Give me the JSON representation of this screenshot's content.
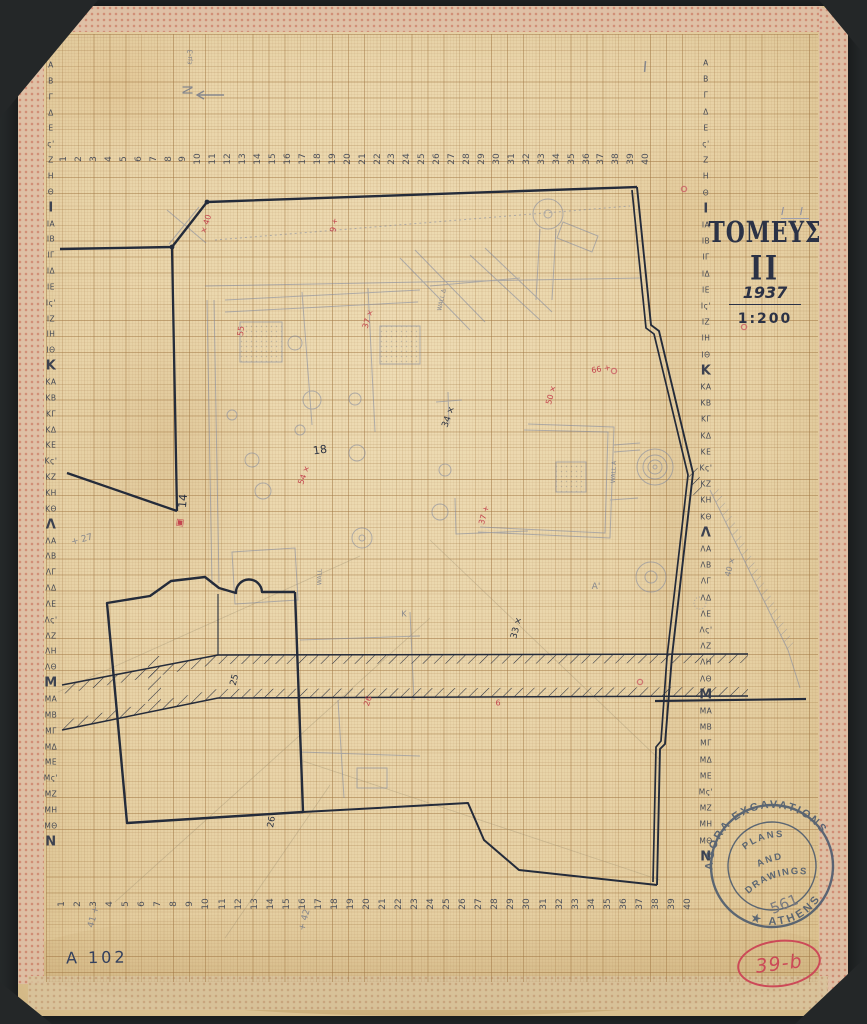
{
  "title_block": {
    "pencil_note": "Ι Ι",
    "title": "ΤΟΜΕΥΣ",
    "title_numeral": "ΙΙ",
    "year": "1937",
    "scale": "1:200"
  },
  "catalog": {
    "drawing_number": "A 102",
    "circled_number": "39-b"
  },
  "stamp": {
    "ring_top": "AGORA EXCAVATIONS",
    "ring_bottom": "★ ATHENS",
    "line1": "PLANS",
    "line2": "AND",
    "line3": "DRAWINGS",
    "number": "561"
  },
  "north": {
    "label": "N"
  },
  "colors": {
    "ink": "#242b3a",
    "red": "#c4464f",
    "pencil": "#7c86a0",
    "stamp": "#45566d",
    "paper": "#e8d3a7"
  },
  "grid": {
    "layout": {
      "top": {
        "x0": 64,
        "dx": 14.93,
        "y": 159
      },
      "bottom": {
        "x0": 62,
        "dx": 16.05,
        "y": 904
      },
      "left": {
        "x": 51,
        "y0": 65,
        "dy": 15.85
      },
      "right": {
        "x": 706,
        "y0": 63,
        "dy": 16.2
      }
    },
    "milestones": [
      "Ι",
      "Κ",
      "Λ",
      "Μ",
      "Ν"
    ],
    "top_numbers": [
      "1",
      "2",
      "3",
      "4",
      "5",
      "6",
      "7",
      "8",
      "9",
      "10",
      "11",
      "12",
      "13",
      "14",
      "15",
      "16",
      "17",
      "18",
      "19",
      "20",
      "21",
      "22",
      "23",
      "24",
      "25",
      "26",
      "27",
      "28",
      "29",
      "30",
      "31",
      "32",
      "33",
      "34",
      "35",
      "36",
      "37",
      "38",
      "39",
      "40"
    ],
    "bottom_numbers": [
      "1",
      "2",
      "3",
      "4",
      "5",
      "6",
      "7",
      "8",
      "9",
      "10",
      "11",
      "12",
      "13",
      "14",
      "15",
      "16",
      "17",
      "18",
      "19",
      "20",
      "21",
      "22",
      "23",
      "24",
      "25",
      "26",
      "27",
      "28",
      "29",
      "30",
      "31",
      "32",
      "33",
      "34",
      "35",
      "36",
      "37",
      "38",
      "39",
      "40"
    ],
    "left_letters": [
      "Α",
      "Β",
      "Γ",
      "Δ",
      "Ε",
      "ς'",
      "Ζ",
      "Η",
      "Θ",
      "Ι",
      "ΙΑ",
      "ΙΒ",
      "ΙΓ",
      "ΙΔ",
      "ΙΕ",
      "Ις'",
      "ΙΖ",
      "ΙΗ",
      "ΙΘ",
      "Κ",
      "ΚΑ",
      "ΚΒ",
      "ΚΓ",
      "ΚΔ",
      "ΚΕ",
      "Κς'",
      "ΚΖ",
      "ΚΗ",
      "ΚΘ",
      "Λ",
      "ΛΑ",
      "ΛΒ",
      "ΛΓ",
      "ΛΔ",
      "ΛΕ",
      "Λς'",
      "ΛΖ",
      "ΛΗ",
      "ΛΘ",
      "Μ",
      "ΜΑ",
      "ΜΒ",
      "ΜΓ",
      "ΜΔ",
      "ΜΕ",
      "Μς'",
      "ΜΖ",
      "ΜΗ",
      "ΜΘ",
      "Ν"
    ],
    "right_letters": [
      "Α",
      "Β",
      "Γ",
      "Δ",
      "Ε",
      "ς'",
      "Ζ",
      "Η",
      "Θ",
      "Ι",
      "ΙΑ",
      "ΙΒ",
      "ΙΓ",
      "ΙΔ",
      "ΙΕ",
      "Ις'",
      "ΙΖ",
      "ΙΗ",
      "ΙΘ",
      "Κ",
      "ΚΑ",
      "ΚΒ",
      "ΚΓ",
      "ΚΔ",
      "ΚΕ",
      "Κς'",
      "ΚΖ",
      "ΚΗ",
      "ΚΘ",
      "Λ",
      "ΛΑ",
      "ΛΒ",
      "ΛΓ",
      "ΛΔ",
      "ΛΕ",
      "Λς'",
      "ΛΖ",
      "ΛΗ",
      "ΛΘ",
      "Μ",
      "ΜΑ",
      "ΜΒ",
      "ΜΓ",
      "ΜΔ",
      "ΜΕ",
      "Μς'",
      "ΜΖ",
      "ΜΗ",
      "ΜΘ",
      "Ν"
    ]
  },
  "annotations": [
    {
      "t": "× 40",
      "x": 206,
      "y": 224,
      "r": -72,
      "c": "red",
      "s": 8
    },
    {
      "t": "9 +",
      "x": 334,
      "y": 225,
      "r": -80,
      "c": "red",
      "s": 8
    },
    {
      "t": "55",
      "x": 241,
      "y": 331,
      "r": -85,
      "c": "red",
      "s": 8
    },
    {
      "t": "37 ×",
      "x": 368,
      "y": 319,
      "r": -72,
      "c": "red",
      "s": 8
    },
    {
      "t": "50 ×",
      "x": 551,
      "y": 395,
      "r": -75,
      "c": "red",
      "s": 8
    },
    {
      "t": "66 +",
      "x": 601,
      "y": 369,
      "r": -10,
      "c": "red",
      "s": 8
    },
    {
      "t": "54 ×",
      "x": 304,
      "y": 475,
      "r": -70,
      "c": "red",
      "s": 8
    },
    {
      "t": "37 +",
      "x": 484,
      "y": 515,
      "r": -75,
      "c": "red",
      "s": 8
    },
    {
      "t": "26",
      "x": 368,
      "y": 701,
      "r": -72,
      "c": "red",
      "s": 8
    },
    {
      "t": "6",
      "x": 498,
      "y": 703,
      "r": 0,
      "c": "red",
      "s": 8
    },
    {
      "t": "▣",
      "x": 180,
      "y": 523,
      "r": 8,
      "c": "red",
      "s": 9
    },
    {
      "t": "14",
      "x": 183,
      "y": 501,
      "r": -85,
      "c": "ink",
      "s": 11
    },
    {
      "t": "18",
      "x": 320,
      "y": 450,
      "r": -8,
      "c": "ink",
      "s": 11
    },
    {
      "t": "34 ×",
      "x": 449,
      "y": 417,
      "r": -70,
      "c": "ink",
      "s": 9
    },
    {
      "t": "33 ×",
      "x": 517,
      "y": 628,
      "r": -75,
      "c": "ink",
      "s": 9
    },
    {
      "t": "25",
      "x": 235,
      "y": 680,
      "r": -75,
      "c": "ink",
      "s": 9
    },
    {
      "t": "26",
      "x": 272,
      "y": 822,
      "r": -80,
      "c": "ink",
      "s": 9
    },
    {
      "t": "+ 27",
      "x": 82,
      "y": 540,
      "r": -15,
      "c": "pencil",
      "s": 9
    },
    {
      "t": "41 +",
      "x": 94,
      "y": 917,
      "r": -75,
      "c": "pencil",
      "s": 9
    },
    {
      "t": "+ 42",
      "x": 305,
      "y": 920,
      "r": -75,
      "c": "pencil",
      "s": 9
    },
    {
      "t": "N",
      "x": 186,
      "y": 90,
      "r": 90,
      "c": "pencil",
      "s": 13
    },
    {
      "t": "εμ-3",
      "x": 190,
      "y": 57,
      "r": -85,
      "c": "pencil",
      "s": 7
    },
    {
      "t": "Ι",
      "x": 645,
      "y": 67,
      "r": 5,
      "c": "pencil",
      "s": 15
    },
    {
      "t": "40 ×",
      "x": 730,
      "y": 567,
      "r": -75,
      "c": "pencil",
      "s": 8
    },
    {
      "t": "A'",
      "x": 596,
      "y": 587,
      "r": 0,
      "c": "pencil",
      "s": 9
    },
    {
      "t": "K",
      "x": 404,
      "y": 614,
      "r": 0,
      "c": "pencil",
      "s": 8
    },
    {
      "t": "WALL A",
      "x": 614,
      "y": 472,
      "r": -87,
      "c": "pencil",
      "s": 6
    },
    {
      "t": "WALL Δ",
      "x": 442,
      "y": 300,
      "r": -78,
      "c": "pencil",
      "s": 6
    },
    {
      "t": "WALL",
      "x": 320,
      "y": 577,
      "r": -88,
      "c": "pencil",
      "s": 6
    }
  ]
}
